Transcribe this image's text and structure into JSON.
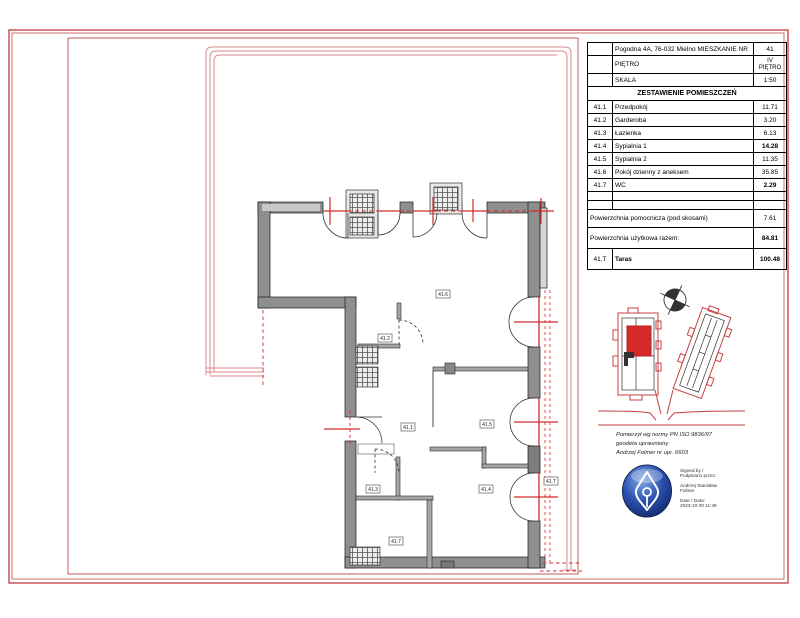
{
  "title_block": {
    "address_label": "Pogodna 4A, 76-032 Mielno MIESZKANIE NR",
    "apartment_number": "41",
    "floor_label": "PIĘTRO",
    "floor_value": "IV PIĘTRO",
    "scale_label": "SKALA",
    "scale_value": "1:50",
    "table_header": "ZESTAWIENIE POMIESZCZEŃ",
    "rows": [
      {
        "no": "41.1",
        "name": "Przedpokój",
        "area": "11.71"
      },
      {
        "no": "41.2",
        "name": "Garderoba",
        "area": "3.20"
      },
      {
        "no": "41.3",
        "name": "Łazienka",
        "area": "6.13"
      },
      {
        "no": "41.4",
        "name": "Sypialnia 1",
        "area": "14.28"
      },
      {
        "no": "41.5",
        "name": "Sypialnia 2",
        "area": "11.35"
      },
      {
        "no": "41.6",
        "name": "Pokój dzienny z aneksem",
        "area": "35.85"
      },
      {
        "no": "41.7",
        "name": "WC",
        "area": "2.29"
      }
    ],
    "aux_label": "Powierzchnia pomocnicza (pod skosami)",
    "aux_value": "7.61",
    "total_label": "Powierzchnia użytkowa razem:",
    "total_value": "84.81",
    "terrace_no": "41.T",
    "terrace_name": "Taras",
    "terrace_value": "100.48"
  },
  "plan": {
    "labels": {
      "living": "41.6",
      "wardrobe": "41.2",
      "hall": "41.1",
      "bedroom2": "41.5",
      "bath": "41.3",
      "bedroom1": "41.4",
      "terrace": "41.T",
      "wc": "41.7"
    }
  },
  "surveyor": {
    "line1": "Pomierzył wg normy  PN ISO 9836/97",
    "line2": "geodeta uprawniony",
    "line3": "Andrzej Folmer nr upr. 6603"
  },
  "signature": {
    "signed_by1": "Signed by /",
    "signed_by2": "Podpisano przez:",
    "name1": "Andrzej Stanisław",
    "name2": "Folmer",
    "date_label": "Date / Data:",
    "date_value": "2023-10-30 11:49"
  },
  "colors": {
    "border_red": "#c24a4a",
    "accent_red": "#d42a2a",
    "terrace_red": "#d98a8a",
    "wall_gray": "#8f8f8f",
    "stamp_blue": "#2a4fae"
  }
}
